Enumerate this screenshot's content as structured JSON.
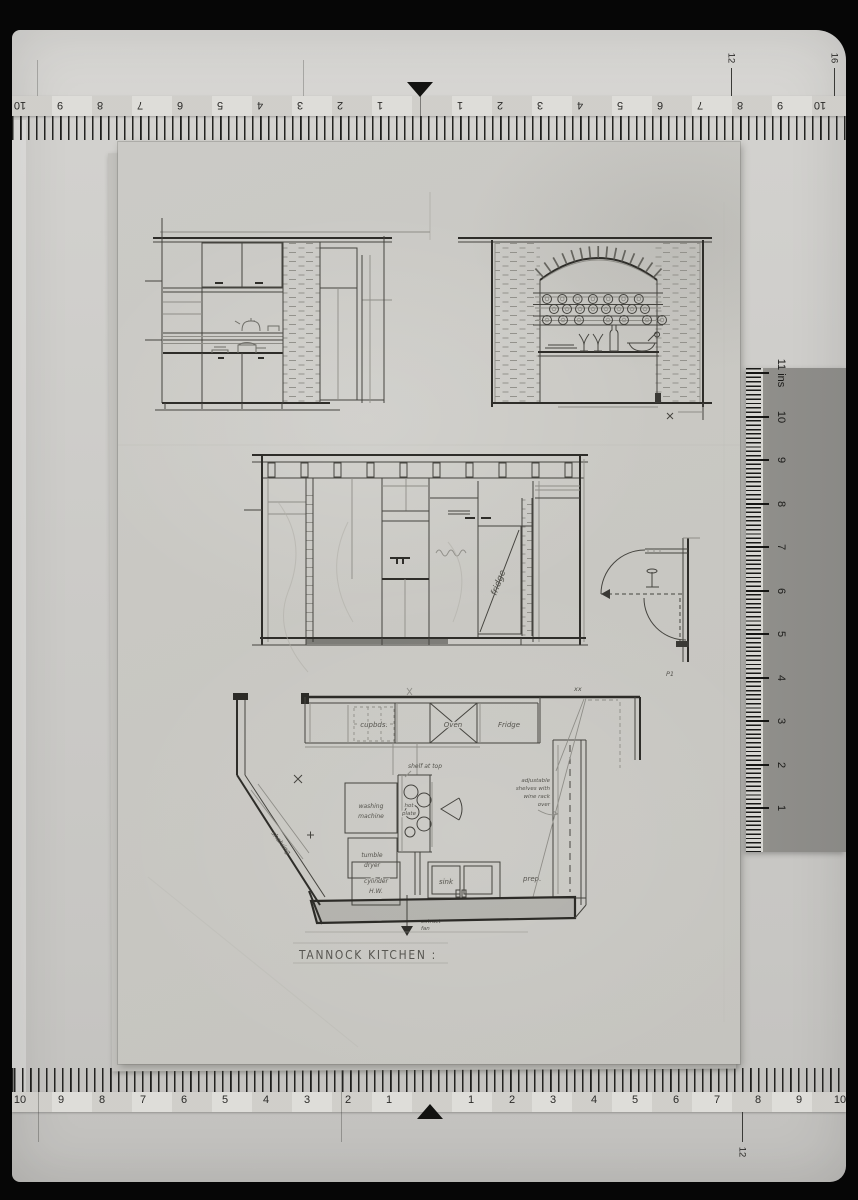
{
  "sheet": {
    "title": "TANNOCK KITCHEN :",
    "elevation_c": {
      "fridge_label": "fridge"
    },
    "detail": {
      "mark": "P1"
    },
    "plan": {
      "top_row": {
        "cupboards": "cupbds.",
        "oven": "Oven",
        "fridge": "Fridge"
      },
      "corner_mark": "xx",
      "washing_machine": [
        "washing",
        "machine"
      ],
      "dryer": [
        "tumble",
        "dryer"
      ],
      "hot_plate": [
        "hot",
        "plate"
      ],
      "shelf_note": "shelf at top",
      "cylinder": [
        "cylinder",
        "H.W."
      ],
      "sink": "sink",
      "prep": "prep.",
      "shelving": "shelving",
      "extract": [
        "extract",
        "fan"
      ],
      "right_note": [
        "adjustable",
        "shelves with",
        "wine rack",
        "over"
      ]
    }
  },
  "rulers": {
    "top": {
      "left": [
        {
          "v": "1",
          "x": 380
        },
        {
          "v": "2",
          "x": 340
        },
        {
          "v": "3",
          "x": 300
        },
        {
          "v": "4",
          "x": 260
        },
        {
          "v": "5",
          "x": 220
        },
        {
          "v": "6",
          "x": 180
        },
        {
          "v": "7",
          "x": 140
        },
        {
          "v": "8",
          "x": 100
        },
        {
          "v": "9",
          "x": 60
        },
        {
          "v": "10",
          "x": 20
        }
      ],
      "right": [
        {
          "v": "1",
          "x": 460
        },
        {
          "v": "2",
          "x": 500
        },
        {
          "v": "3",
          "x": 540
        },
        {
          "v": "4",
          "x": 580
        },
        {
          "v": "5",
          "x": 620
        },
        {
          "v": "6",
          "x": 660
        },
        {
          "v": "7",
          "x": 700
        },
        {
          "v": "8",
          "x": 740
        },
        {
          "v": "9",
          "x": 780
        },
        {
          "v": "10",
          "x": 820
        }
      ],
      "extra": [
        {
          "v": "12",
          "x": 731
        },
        {
          "v": "16",
          "x": 834
        }
      ]
    },
    "bottom": {
      "left": [
        {
          "v": "1",
          "x": 389
        },
        {
          "v": "2",
          "x": 348
        },
        {
          "v": "3",
          "x": 307
        },
        {
          "v": "4",
          "x": 266
        },
        {
          "v": "5",
          "x": 225
        },
        {
          "v": "6",
          "x": 184
        },
        {
          "v": "7",
          "x": 143
        },
        {
          "v": "8",
          "x": 102
        },
        {
          "v": "9",
          "x": 61
        },
        {
          "v": "10",
          "x": 20
        }
      ],
      "right": [
        {
          "v": "1",
          "x": 471
        },
        {
          "v": "2",
          "x": 512
        },
        {
          "v": "3",
          "x": 553
        },
        {
          "v": "4",
          "x": 594
        },
        {
          "v": "5",
          "x": 635
        },
        {
          "v": "6",
          "x": 676
        },
        {
          "v": "7",
          "x": 717
        },
        {
          "v": "8",
          "x": 758
        },
        {
          "v": "9",
          "x": 799
        },
        {
          "v": "10",
          "x": 840
        }
      ],
      "extra": [
        {
          "v": "12",
          "x": 742
        }
      ]
    },
    "side": {
      "marks": [
        {
          "v": "1",
          "y": 808
        },
        {
          "v": "2",
          "y": 765
        },
        {
          "v": "3",
          "y": 721
        },
        {
          "v": "4",
          "y": 678
        },
        {
          "v": "5",
          "y": 634
        },
        {
          "v": "6",
          "y": 591
        },
        {
          "v": "7",
          "y": 547
        },
        {
          "v": "8",
          "y": 504
        },
        {
          "v": "9",
          "y": 460
        },
        {
          "v": "10",
          "y": 417
        },
        {
          "v": "11 ins",
          "y": 373
        }
      ]
    }
  }
}
